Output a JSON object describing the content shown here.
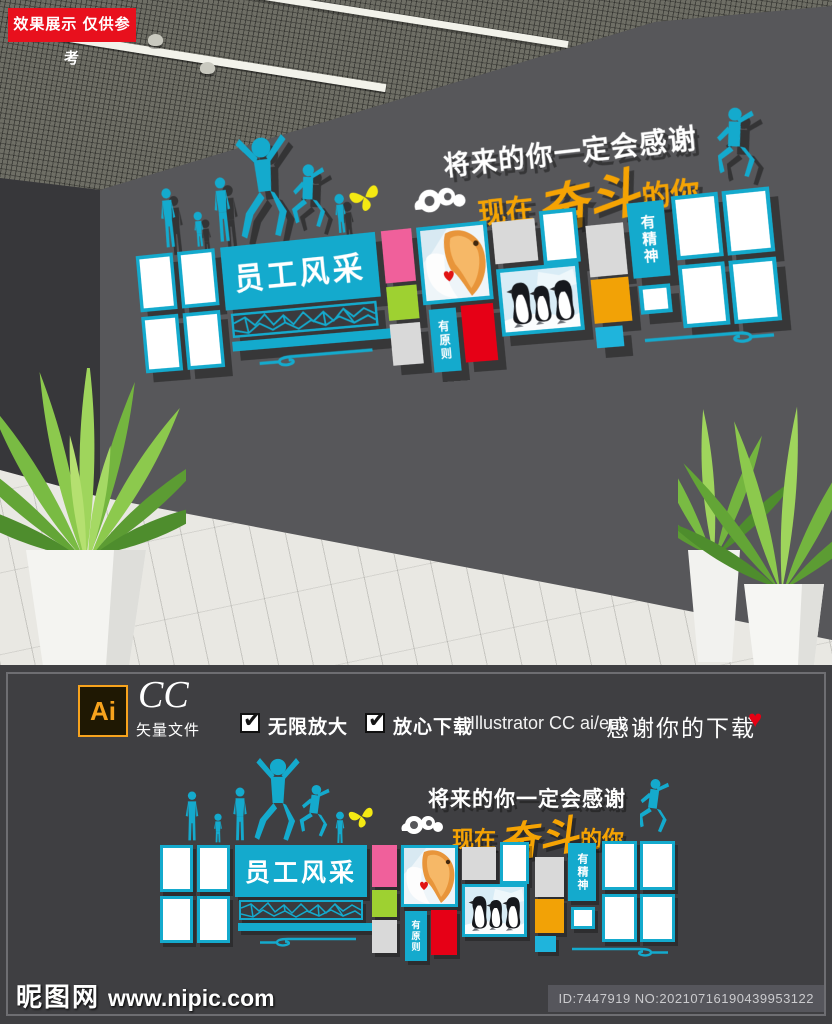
{
  "badge": {
    "text": "效果展示 仅供参考"
  },
  "license_bar": {
    "logo_text": "Ai",
    "edition": "CC",
    "file_type": "矢量文件",
    "check_glyph": "✔",
    "feature_1": "无限放大",
    "feature_2": "放心下载",
    "software": "Illustrator CC  ai/eps",
    "thanks": "感谢你的下载",
    "heart_glyph": "♥"
  },
  "wall_design": {
    "headline": "将来的你一定会感谢",
    "subhead_prefix": "现在",
    "subhead_script": "奋斗",
    "subhead_suffix": "的你",
    "board_title": "员工风采",
    "strip_principle": "有原则",
    "strip_spirit": "有精神"
  },
  "footer": {
    "site_name": "昵图网",
    "site_url": "www.nipic.com",
    "image_id": "ID:7447919 NO:20210716190439953122"
  },
  "colors": {
    "cyan": "#14aacd",
    "pink": "#f0609b",
    "green": "#9ed131",
    "red": "#e60016",
    "orange": "#f2a206",
    "orange_text": "#f5a303",
    "badge_red": "#e8101d",
    "wall_gray": "#57575a",
    "panel_gray": "#3f3f42"
  }
}
